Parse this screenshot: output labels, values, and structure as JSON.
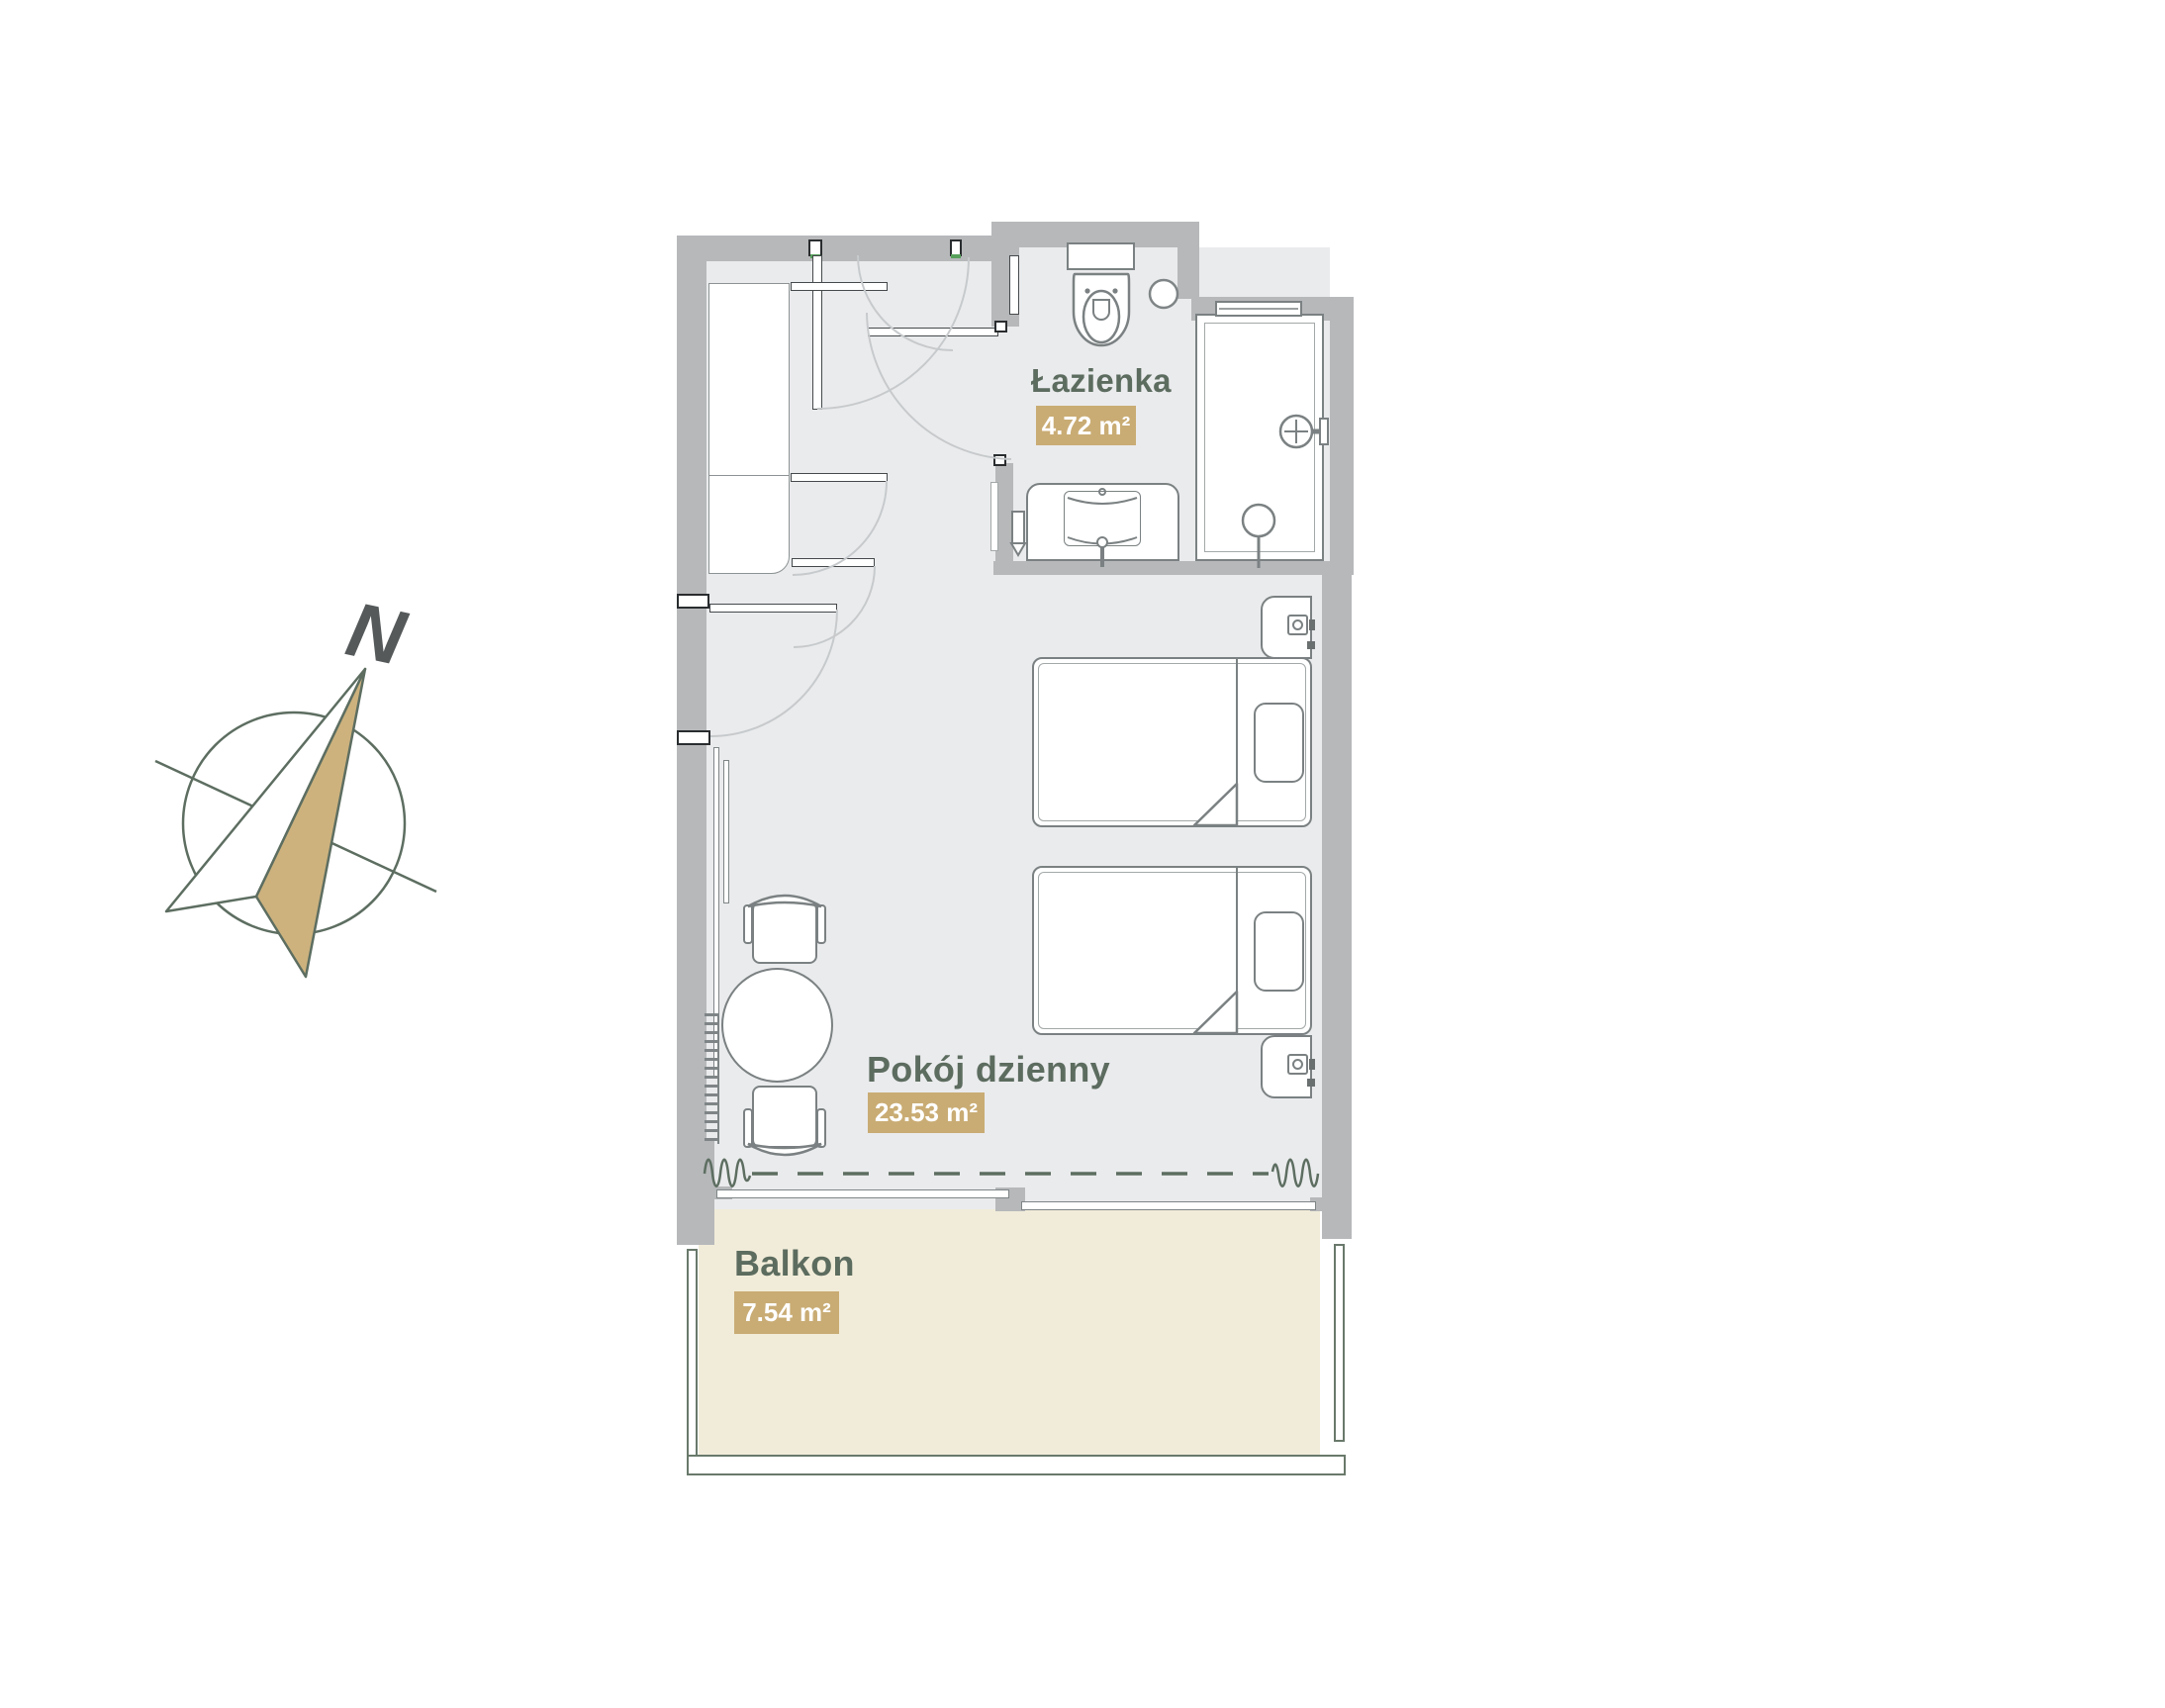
{
  "plan": {
    "rooms": [
      {
        "name": "Łazienka",
        "area": "4.72 m²"
      },
      {
        "name": "Pokój dzienny",
        "area": "23.53 m²"
      },
      {
        "name": "Balkon",
        "area": "7.54 m²"
      }
    ],
    "compass": {
      "north": "N"
    },
    "colors": {
      "wall": "#b6b8ba",
      "floor": "#eaebed",
      "balcony_floor": "#f1ecd9",
      "accent_tan": "#c9ac74",
      "label_green": "#5c6c5f",
      "furniture_line": "#7b8182",
      "compass_line": "#5d6e61"
    }
  }
}
